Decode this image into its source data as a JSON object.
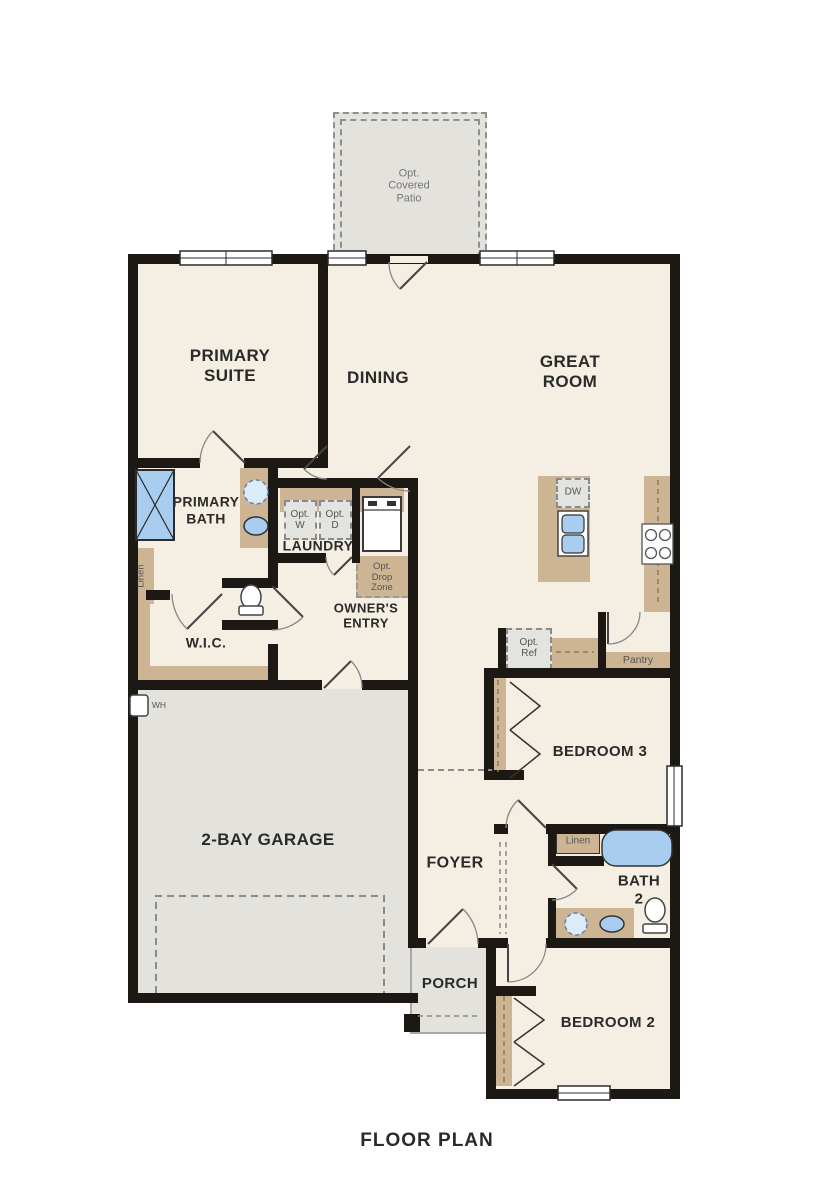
{
  "title": "FLOOR PLAN",
  "rooms": {
    "patio": "Opt.\nCovered\nPatio",
    "primary_suite": "PRIMARY\nSUITE",
    "dining": "DINING",
    "great_room": "GREAT\nROOM",
    "primary_bath": "PRIMARY\nBATH",
    "laundry": "LAUNDRY",
    "owners_entry": "OWNER'S\nENTRY",
    "wic": "W.I.C.",
    "garage": "2-BAY GARAGE",
    "foyer": "FOYER",
    "pantry": "Pantry",
    "bedroom3": "BEDROOM 3",
    "bath2": "BATH\n2",
    "bedroom2": "BEDROOM 2",
    "porch": "PORCH"
  },
  "fixtures": {
    "opt_washer": "Opt.\nW",
    "opt_dryer": "Opt.\nD",
    "fau": "FAU",
    "opt_drop_zone": "Opt.\nDrop\nZone",
    "dishwasher": "DW",
    "opt_fridge": "Opt.\nRef",
    "linen_primary": "Linen",
    "linen_bath2": "Linen",
    "water_heater": "WH",
    "opt_tub": "Opt.",
    "opt_sink": "Opt"
  },
  "colors": {
    "wall": "#1c1813",
    "room_fill": "#f4efe2",
    "concrete_fill": "#e4e2dd",
    "cabinet_fill": "#cdb493",
    "fixture_blue": "#a9cdee"
  }
}
